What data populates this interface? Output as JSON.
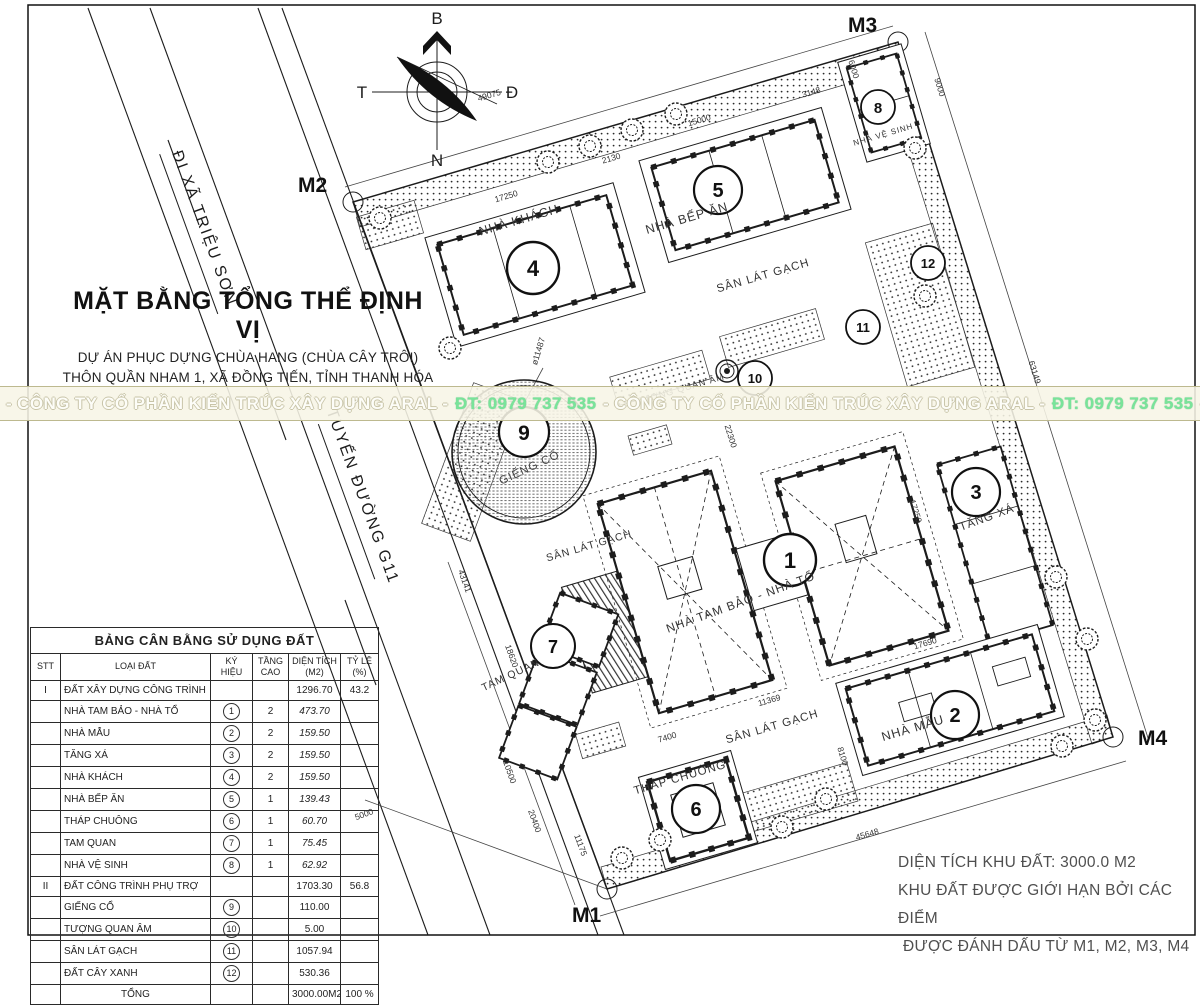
{
  "colors": {
    "ink": "#1c1c1c",
    "band_bg": "#f7f5e6",
    "band_border": "#bdb98f",
    "phone_green": "#79e49a",
    "watermark_text": "#fdfdf8"
  },
  "roads": {
    "label_trieu_son": "ĐI XÃ TRIỆU SƠN",
    "label_g11": "TUYẾN ĐƯỜNG G11"
  },
  "compass": {
    "north": "B",
    "south": "N",
    "west": "T",
    "east": "Đ"
  },
  "title_block": {
    "title": "MẶT BẰNG TỔNG THỂ ĐỊNH VỊ",
    "line1": "DỰ ÁN PHỤC DỰNG CHÙA HANG (CHÙA CÂY TRÔI)",
    "line2": "THÔN QUẦN NHAM 1, XÃ ĐỒNG TIẾN, TỈNH THANH HÓA"
  },
  "watermark": {
    "company1": "- CÔNG TY CỔ PHẦN KIẾN TRÚC XÂY DỰNG ARAL -",
    "phone1": "ĐT: 0979 737 535",
    "company2": "- CÔNG TY CỔ PHẦN KIẾN TRÚC XÂY DỰNG ARAL -",
    "phone2": "ĐT: 0979 737 535",
    "tail": "-"
  },
  "markers": {
    "m1": "M1",
    "m2": "M2",
    "m3": "M3",
    "m4": "M4"
  },
  "badges": {
    "b1": "1",
    "b2": "2",
    "b3": "3",
    "b4": "4",
    "b5": "5",
    "b6": "6",
    "b7": "7",
    "b8": "8",
    "b9": "9",
    "b10": "10",
    "b11": "11",
    "b12": "12"
  },
  "plan_labels": {
    "nha_khach": "NHÀ KHÁCH",
    "nha_bep_an": "NHÀ BẾP ĂN",
    "nha_ve_sinh": "NHÀ VỆ SINH",
    "nha_tam_bao": "NHÀ TAM BẢO - NHÀ TỔ",
    "tang_xa": "TĂNG XÁ",
    "nha_mau": "NHÀ MẪU",
    "thap_chuong": "THÁP CHUÔNG",
    "tam_quan": "TAM QUAN",
    "gieng_co": "GIẾNG CỔ",
    "tuong_quan_am": "TƯỢNG QUAN ÂM",
    "san_lat_gach": "SÂN LÁT GẠCH"
  },
  "dims": {
    "d49075": "49075",
    "d15000": "15000",
    "d3148": "3148",
    "d6000": "6000",
    "d9000": "9000",
    "d2130": "2130",
    "d17250a": "17250",
    "d22300": "22300",
    "d11487": "ø11487",
    "d17690": "17690",
    "d11369": "11369",
    "d45648": "45648",
    "d7400": "7400",
    "d8100": "8100",
    "d17250b": "17250",
    "d43141": "43141",
    "d10500": "10500",
    "d20400": "20400",
    "d11175": "11175",
    "d63149": "63149",
    "d5000": "5000",
    "d18620": "18620"
  },
  "table": {
    "title": "BẢNG CÂN BẰNG SỬ DỤNG ĐẤT",
    "headers": {
      "stt": "STT",
      "loai_dat": "LOẠI ĐẤT",
      "ky_hieu": "KÝ HIỆU",
      "tang_cao": "TẦNG CAO",
      "dien_tich": "DIỆN TÍCH (M2)",
      "ty_le": "TỶ LỆ (%)"
    },
    "rows": [
      {
        "stt": "I",
        "name": "ĐẤT XÂY DỰNG CÔNG TRÌNH",
        "sym": "",
        "floors": "",
        "area": "1296.70",
        "pct": "43.2"
      },
      {
        "stt": "",
        "name": "NHÀ TAM BẢO - NHÀ TỔ",
        "sym": "1",
        "floors": "2",
        "area": "473.70",
        "pct": ""
      },
      {
        "stt": "",
        "name": "NHÀ MẪU",
        "sym": "2",
        "floors": "2",
        "area": "159.50",
        "pct": ""
      },
      {
        "stt": "",
        "name": "TĂNG XÁ",
        "sym": "3",
        "floors": "2",
        "area": "159.50",
        "pct": ""
      },
      {
        "stt": "",
        "name": "NHÀ KHÁCH",
        "sym": "4",
        "floors": "2",
        "area": "159.50",
        "pct": ""
      },
      {
        "stt": "",
        "name": "NHÀ BẾP ĂN",
        "sym": "5",
        "floors": "1",
        "area": "139.43",
        "pct": ""
      },
      {
        "stt": "",
        "name": "THÁP CHUÔNG",
        "sym": "6",
        "floors": "1",
        "area": "60.70",
        "pct": ""
      },
      {
        "stt": "",
        "name": "TAM QUAN",
        "sym": "7",
        "floors": "1",
        "area": "75.45",
        "pct": ""
      },
      {
        "stt": "",
        "name": "NHÀ VỆ SINH",
        "sym": "8",
        "floors": "1",
        "area": "62.92",
        "pct": ""
      },
      {
        "stt": "II",
        "name": "ĐẤT CÔNG TRÌNH PHỤ TRỢ",
        "sym": "",
        "floors": "",
        "area": "1703.30",
        "pct": "56.8"
      },
      {
        "stt": "",
        "name": "GIẾNG CỔ",
        "sym": "9",
        "floors": "",
        "area": "110.00",
        "pct": ""
      },
      {
        "stt": "",
        "name": "TƯỢNG QUAN ÂM",
        "sym": "10",
        "floors": "",
        "area": "5.00",
        "pct": ""
      },
      {
        "stt": "",
        "name": "SÂN LÁT GẠCH",
        "sym": "11",
        "floors": "",
        "area": "1057.94",
        "pct": ""
      },
      {
        "stt": "",
        "name": "ĐẤT CÂY XANH",
        "sym": "12",
        "floors": "",
        "area": "530.36",
        "pct": ""
      },
      {
        "stt": "",
        "name": "TỔNG",
        "sym": "",
        "floors": "",
        "area": "3000.00M2",
        "pct": "100 %"
      }
    ]
  },
  "notes": {
    "line1": "DIỆN TÍCH KHU ĐẤT: 3000.0 M2",
    "line2": "KHU ĐẤT ĐƯỢC GIỚI HẠN BỞI CÁC ĐIỂM",
    "line3": "ĐƯỢC ĐÁNH DẤU TỪ M1, M2, M3, M4"
  }
}
